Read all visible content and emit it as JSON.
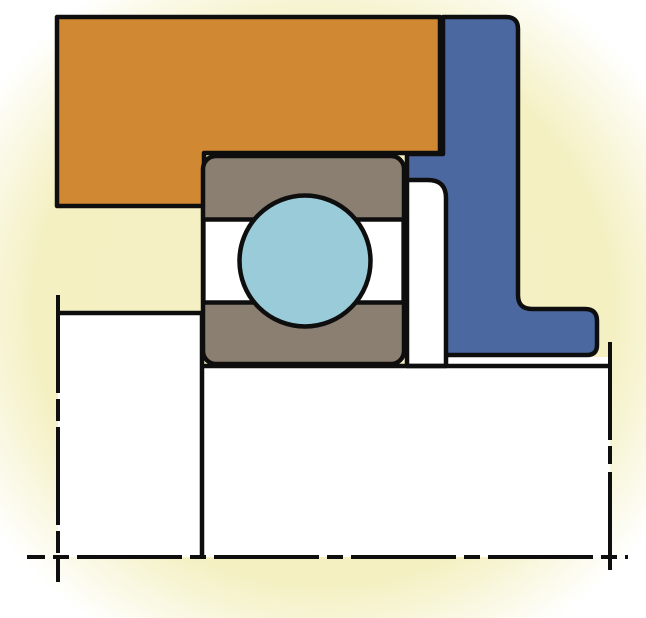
{
  "diagram": {
    "kind": "bearing-mounting-cross-section",
    "description": "Cross-section drawing of a deep groove ball bearing seated on a shaft shoulder, clamped by a housing and a stepped end flange, with dash-dot axis centerlines"
  },
  "colors": {
    "background": "#F5F1C5",
    "background_fade": "#FFFFFF",
    "housing": "#D08833",
    "end_cap": "#4B69A0",
    "bearing_ring": "#8B7F72",
    "ball": "#9ACBD9",
    "white": "#FFFFFF",
    "line": "#0E0E0E"
  },
  "lines": {
    "axis_dash": "105 8 16 8",
    "left_break_dash": "98 6 22 6",
    "right_break_dash": "98 6 18 8"
  },
  "components": [
    {
      "id": "housing-section",
      "label": "housing"
    },
    {
      "id": "end-cap-section",
      "label": "end flange"
    },
    {
      "id": "bearing-ring-section",
      "label": "bearing rings"
    },
    {
      "id": "ball-rolling-element",
      "label": "ball"
    },
    {
      "id": "spacer-section",
      "label": "spacer ring"
    },
    {
      "id": "shaft-section",
      "label": "shaft"
    },
    {
      "id": "shoulder-section",
      "label": "shaft shoulder"
    },
    {
      "id": "axis-centerline",
      "label": "axis of rotation"
    }
  ]
}
